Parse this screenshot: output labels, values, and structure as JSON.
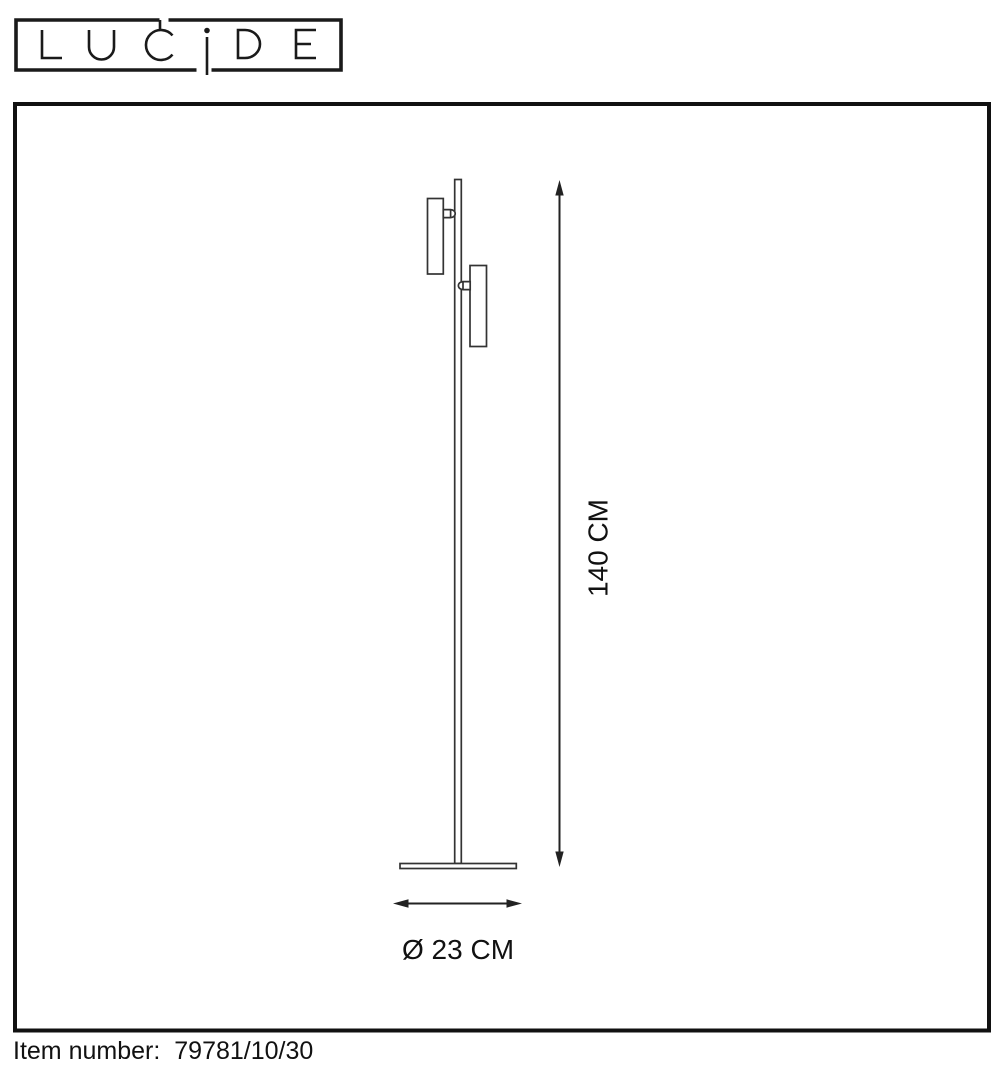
{
  "logo": {
    "brand": "LUCIDE"
  },
  "diagram": {
    "height_label": "140 CM",
    "diameter_label": "Ø 23 CM"
  },
  "footer": {
    "item_label": "Item number:",
    "item_value": "79781/10/30"
  },
  "colors": {
    "ink": "#1a1a1a",
    "lamp_line": "#333333",
    "background": "#ffffff"
  }
}
